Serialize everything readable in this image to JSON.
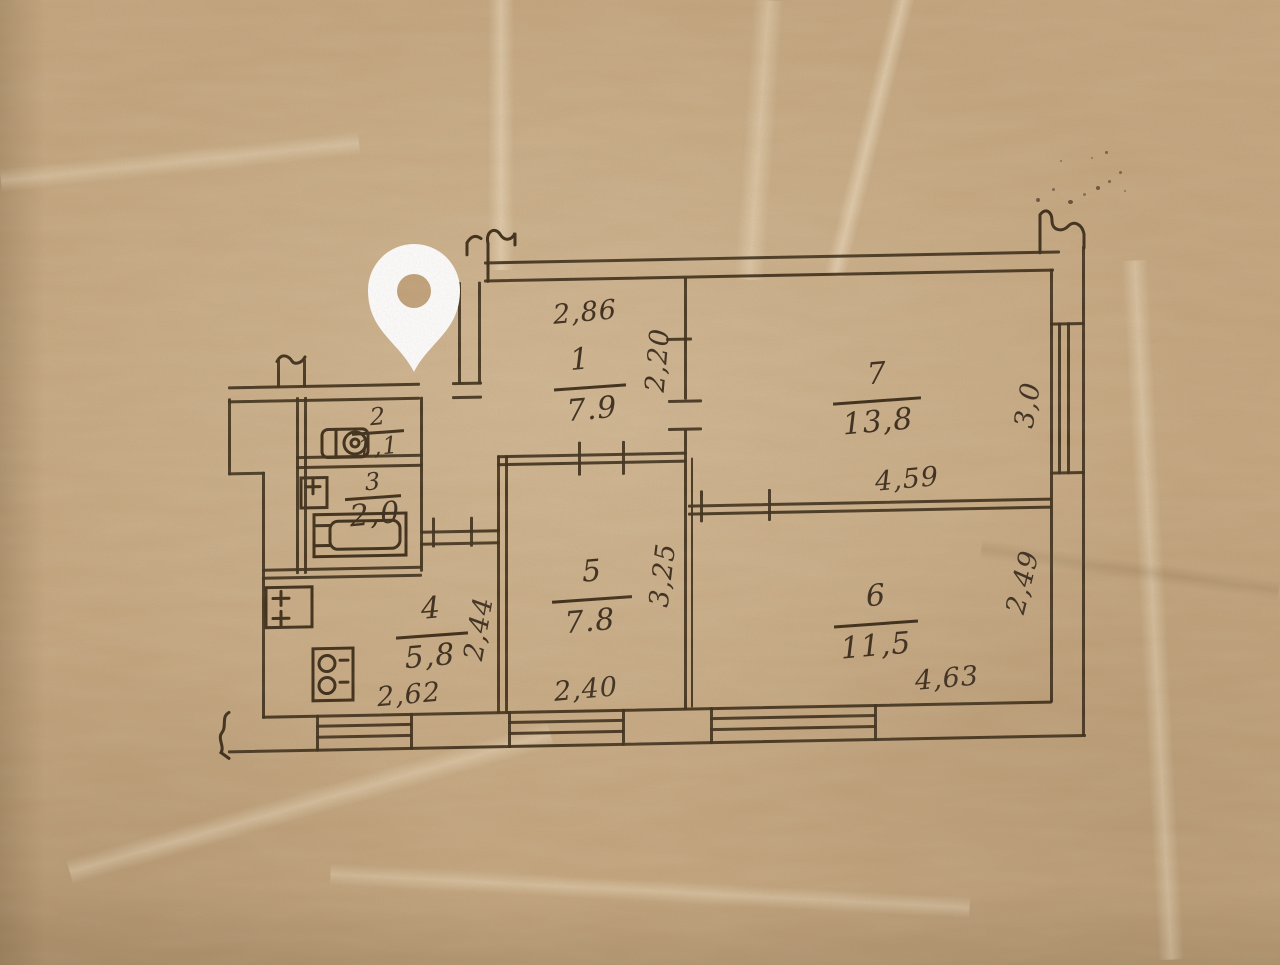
{
  "plan": {
    "title": "hand-drawn apartment floor plan on kraft paper",
    "paper_color": "#c2a47d",
    "ink_color": "#3a2a16",
    "marker_color": "#ffffff",
    "rooms": [
      {
        "number": "1",
        "area": "7.9"
      },
      {
        "number": "2",
        "area": "1,1"
      },
      {
        "number": "3",
        "area": "2,0"
      },
      {
        "number": "4",
        "area": "5,8"
      },
      {
        "number": "5",
        "area": "7.8"
      },
      {
        "number": "6",
        "area": "11,5"
      },
      {
        "number": "7",
        "area": "13,8"
      }
    ],
    "dims": {
      "hall_width": "2,86",
      "hall_depth": "2,20",
      "room7_width": "4,59",
      "room7_depth": "3,0",
      "room5_width": "2,40",
      "room5_depth": "3,25",
      "room6_width": "4,63",
      "room6_depth": "2,49",
      "kitchen_width": "2,62",
      "kitchen_depth": "2,44"
    },
    "fixtures": [
      "toilet-icon",
      "sink-icon",
      "bathtub-icon",
      "heater-icon",
      "stove-icon"
    ],
    "marker": "location-pin-icon"
  }
}
